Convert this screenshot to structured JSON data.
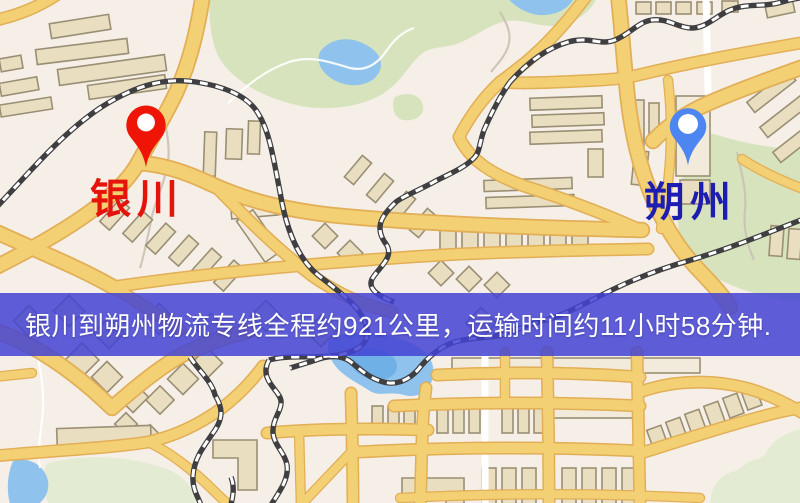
{
  "banner": {
    "text": "银川到朔州物流专线全程约921公里，运输时间约11小时58分钟."
  },
  "markers": {
    "origin": {
      "label": "银川"
    },
    "destination": {
      "label": "朔州"
    }
  },
  "icons": {
    "origin_pin": "red-map-pin",
    "destination_pin": "blue-map-pin"
  },
  "colors": {
    "background": "#f6efe7",
    "road": "#f3d074",
    "road_casing": "#e2ae56",
    "water": "#8fc2ec",
    "water_deep": "#6fb0e6",
    "park": "#d7e3bd",
    "park_light": "#e3ecd2",
    "building": "#e9dfc0",
    "building_light": "#f2ebdb",
    "building_outline": "#9a8f74",
    "railway_dark": "#3f3f42",
    "railway_light": "#ffffff",
    "banner_overlay": "rgba(67,67,212,0.85)",
    "banner_text": "#ffffff",
    "origin_pin": "#ee1506",
    "origin_label": "#e51309",
    "destination_pin": "#4d86f0",
    "destination_label": "#1d1db2",
    "pin_inner": "#ffffff"
  }
}
